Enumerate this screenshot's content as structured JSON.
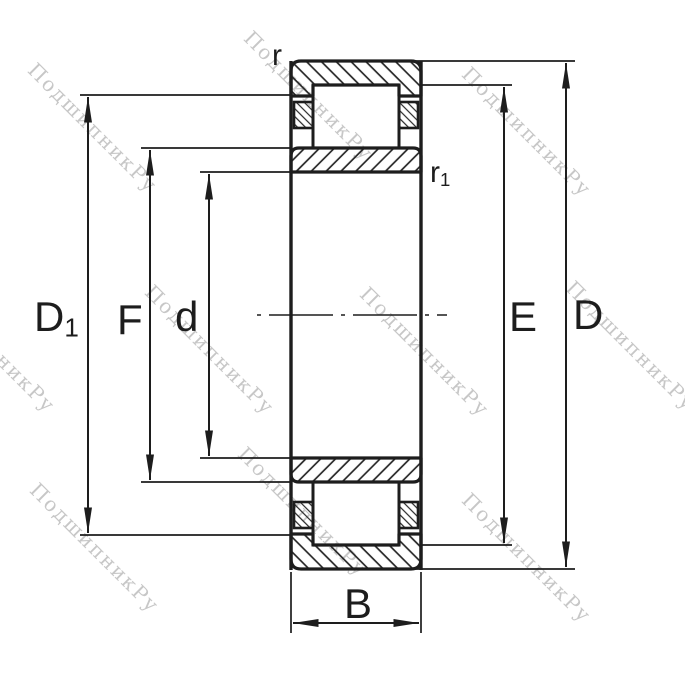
{
  "drawing": {
    "type": "bearing-cross-section-technical-drawing",
    "watermark": {
      "text": "ПодшипникРу"
    },
    "labels": {
      "r": "r",
      "r1": {
        "base": "r",
        "sub": "1"
      },
      "D1": {
        "base": "D",
        "sub": "1"
      },
      "F": "F",
      "d": "d",
      "E": "E",
      "D": "D",
      "B": "B"
    },
    "colors": {
      "line": "#1d1d1d",
      "watermark": "#c7c7c7",
      "background": "#ffffff"
    }
  }
}
